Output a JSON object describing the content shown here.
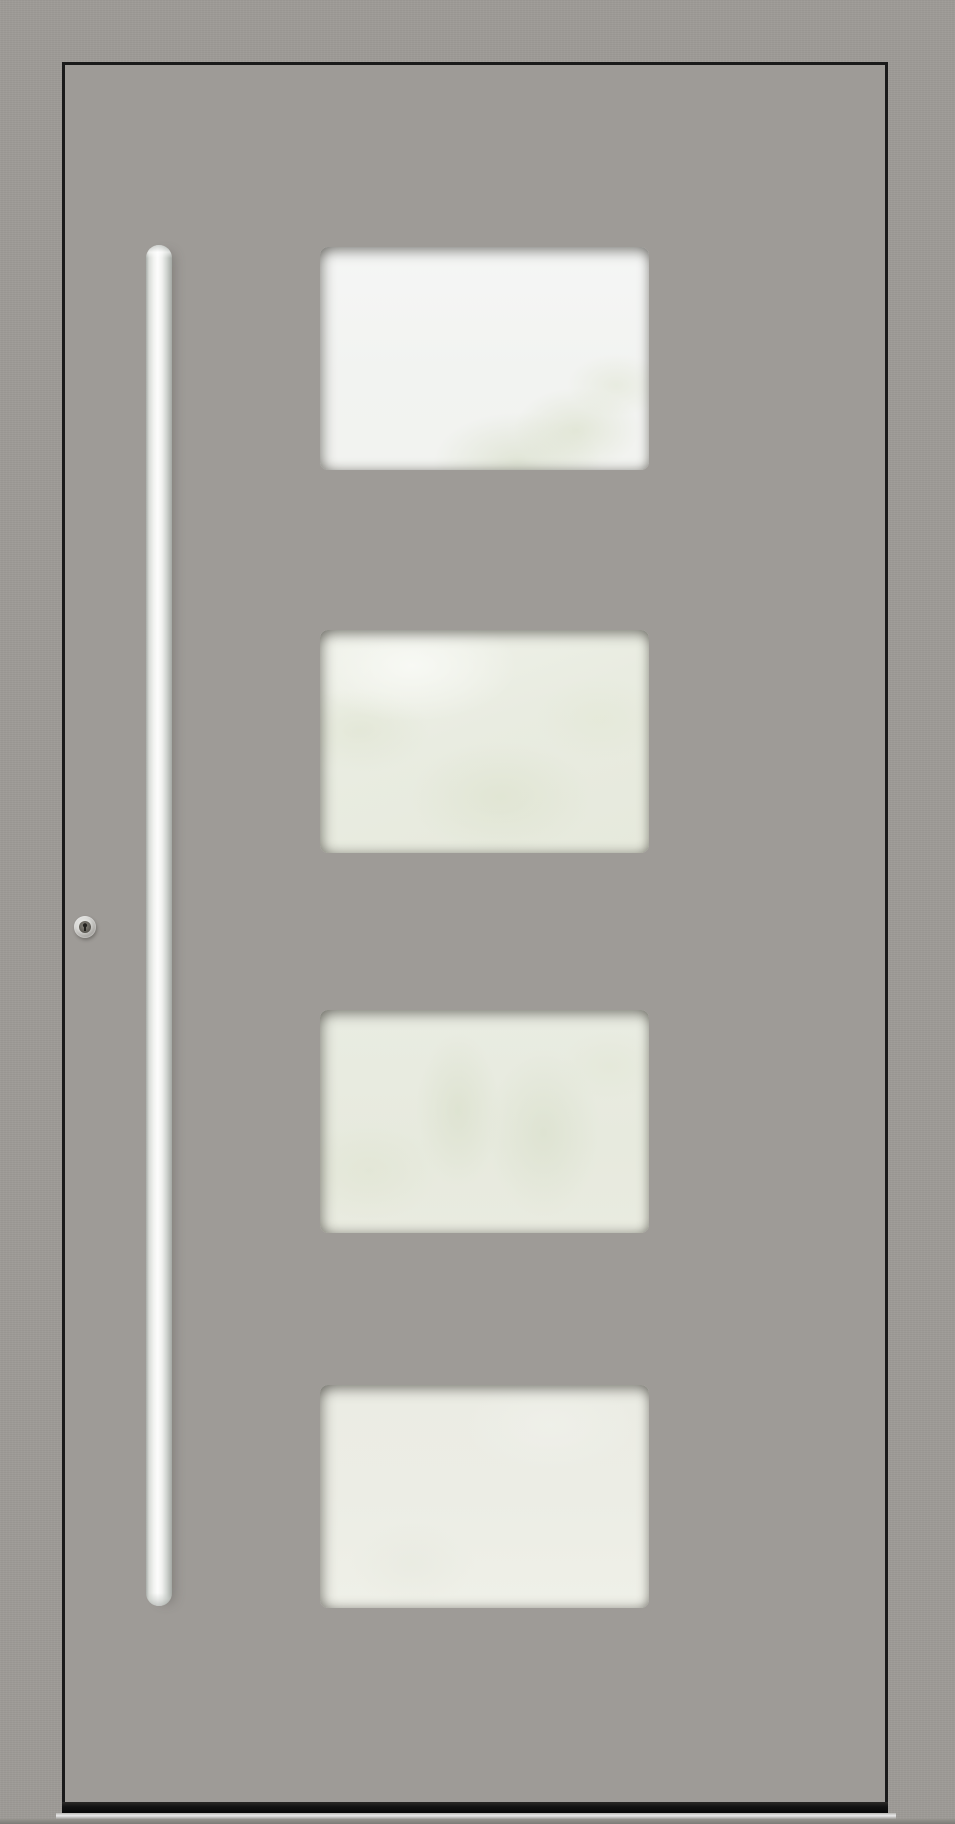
{
  "meta": {
    "title": "Grey aluminium entrance door, front view, with four frosted glass panes, long stainless bar handle and profile cylinder lock"
  },
  "scene": {
    "colors": {
      "wall": "#9e9b97",
      "door": "#9e9b97",
      "outline": "#1a1a1a",
      "handle_highlight": "#fdfdfd",
      "handle_shade": "#a3a8a3",
      "lock_ring": "#d8d8d5",
      "lock_core": "#57544e",
      "glass_1": "#f2f3f0",
      "glass_2": "#e9ece1",
      "glass_3": "#e7eade",
      "glass_4": "#ecede5",
      "bottom_gap": "#121212",
      "threshold_strip": "#e9e9e9"
    },
    "parts": {
      "door_leaf": "flush grey aluminium leaf outlined by dark shadow groove",
      "glass_panels": [
        {
          "id": 1,
          "look": "bright frosted white, faint foliage reflection lower right"
        },
        {
          "id": 2,
          "look": "frosted green-grey, light streak upper left, foliage blur"
        },
        {
          "id": 3,
          "look": "frosted green-grey, faint branch silhouettes"
        },
        {
          "id": 4,
          "look": "frosted pale cream, nearly uniform"
        }
      ],
      "handle": "full-height round stainless steel pull bar on the left side",
      "lock": "round stainless escutcheon with dark keyhole, left of handle",
      "threshold": "dark floor gap above a polished aluminium threshold strip"
    }
  }
}
